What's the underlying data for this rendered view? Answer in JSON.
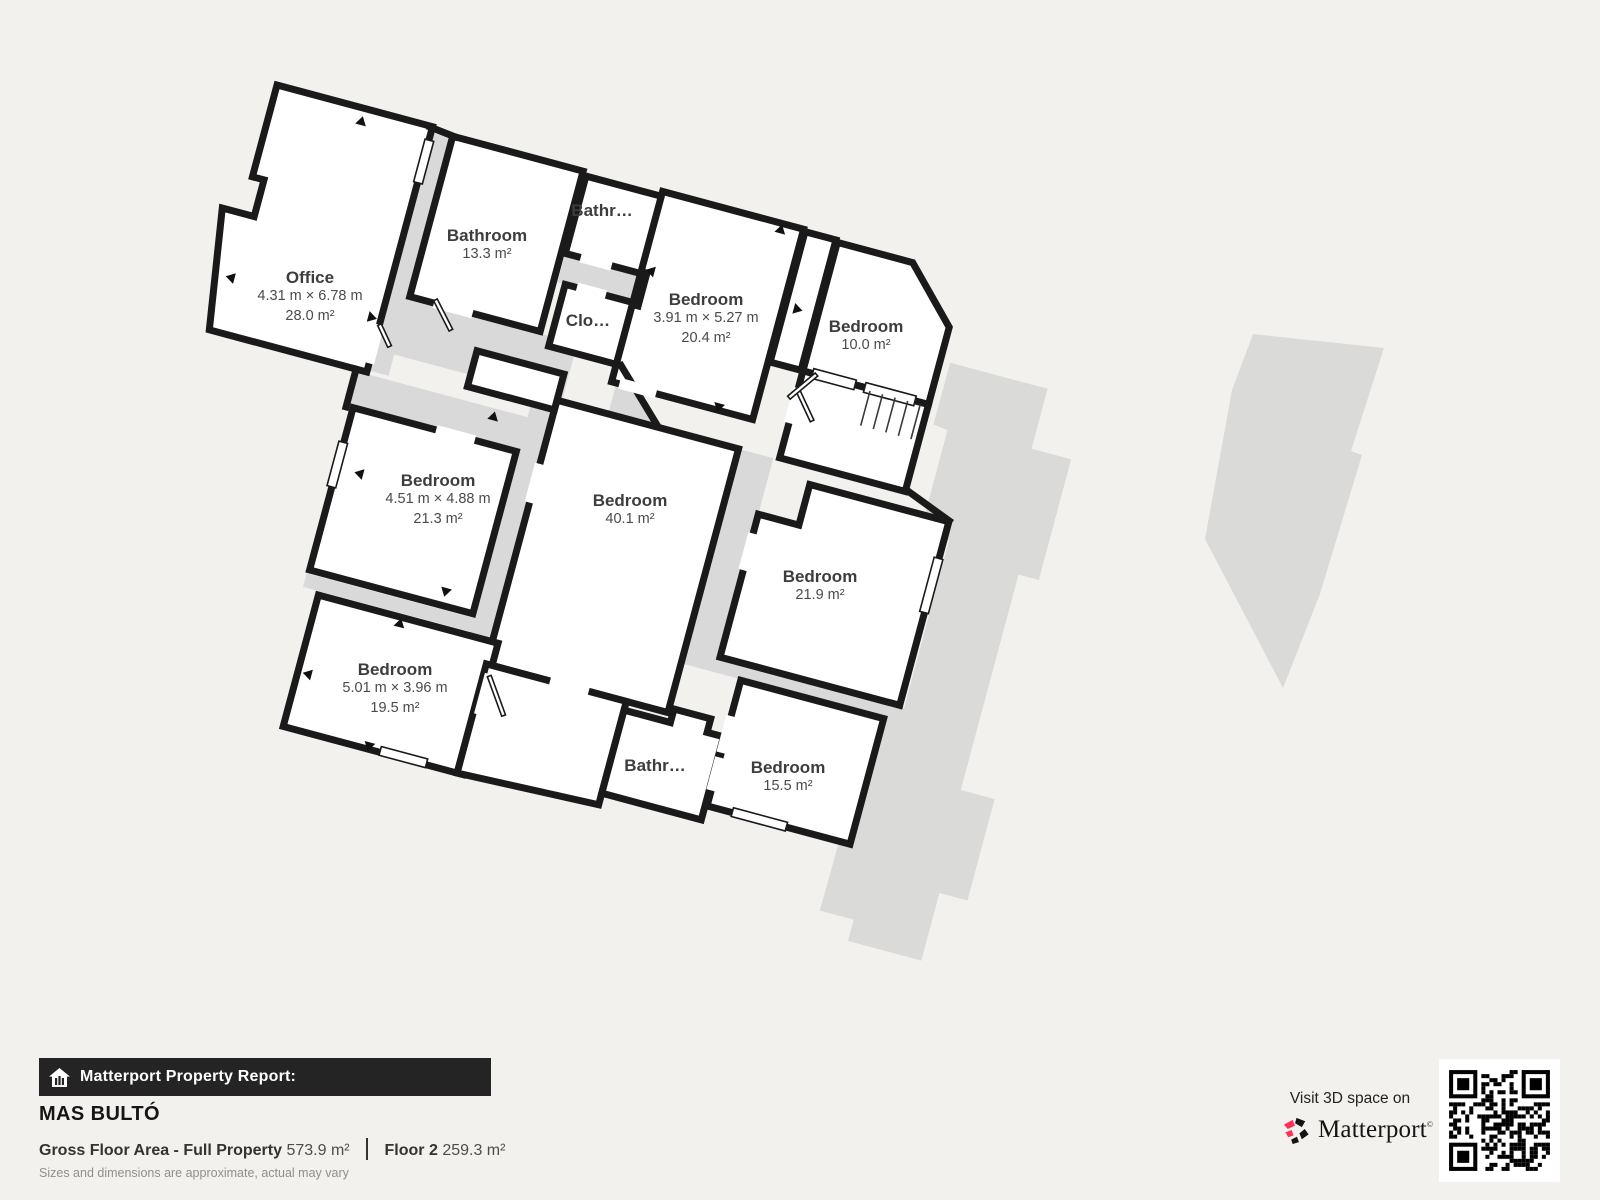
{
  "plan": {
    "rooms": [
      {
        "id": "office",
        "name": "Office",
        "dims": "4.31 m × 6.78 m",
        "area": "28.0 m²"
      },
      {
        "id": "bathroom-top",
        "name": "Bathroom",
        "area": "13.3 m²"
      },
      {
        "id": "bathroom-small-top",
        "name": "Bathr…"
      },
      {
        "id": "closet",
        "name": "Clo…"
      },
      {
        "id": "bedroom-ne",
        "name": "Bedroom",
        "dims": "3.91 m × 5.27 m",
        "area": "20.4 m²"
      },
      {
        "id": "bedroom-e",
        "name": "Bedroom",
        "area": "10.0 m²"
      },
      {
        "id": "bedroom-w",
        "name": "Bedroom",
        "dims": "4.51 m × 4.88 m",
        "area": "21.3 m²"
      },
      {
        "id": "bedroom-center",
        "name": "Bedroom",
        "area": "40.1 m²"
      },
      {
        "id": "bedroom-se",
        "name": "Bedroom",
        "area": "21.9 m²"
      },
      {
        "id": "bedroom-sw",
        "name": "Bedroom",
        "dims": "5.01 m × 3.96 m",
        "area": "19.5 m²"
      },
      {
        "id": "bathroom-bottom",
        "name": "Bathr…"
      },
      {
        "id": "bedroom-s",
        "name": "Bedroom",
        "area": "15.5 m²"
      }
    ]
  },
  "footer": {
    "report_label": "Matterport Property Report:",
    "property_name": "MAS BULTÓ",
    "gross_area_label": "Gross Floor Area - Full Property",
    "gross_area_value": "573.9 m²",
    "floor_label": "Floor 2",
    "floor_area_value": "259.3 m²",
    "disclaimer": "Sizes and dimensions are approximate, actual may vary"
  },
  "cta": {
    "visit_text": "Visit 3D space on",
    "brand": "Matterport",
    "brand_mark": "©"
  },
  "colors": {
    "background": "#f2f1ee",
    "wall": "#1a1a1a",
    "room_fill": "#ffffff",
    "corridor": "#d9d9d9",
    "silhouette": "#dadbd8",
    "label": "#3d3d3d",
    "brand_pink": "#ff3158",
    "bar_bg": "#242424"
  }
}
